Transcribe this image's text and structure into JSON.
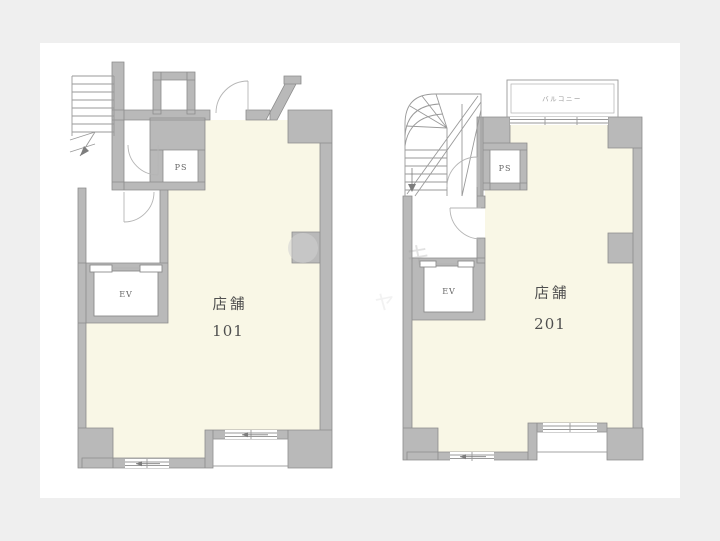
{
  "page": {
    "background_color": "#efefef",
    "canvas_background_color": "#ffffff"
  },
  "colors": {
    "wall": "#b9b9b9",
    "wall_outline": "#8c8c8c",
    "room_fill": "#f9f7e6",
    "line": "#9a9a9a",
    "label_text": "#4f4f4f"
  },
  "plans": [
    {
      "id": "unit-101",
      "room_label": "店舗",
      "unit_number": "101",
      "pipe_space_label": "PS",
      "elevator_label": "EV"
    },
    {
      "id": "unit-201",
      "room_label": "店舗",
      "unit_number": "201",
      "pipe_space_label": "PS",
      "elevator_label": "EV",
      "balcony_label": "バルコニー"
    }
  ],
  "watermark": {
    "characters": [
      "キ",
      "ャ"
    ]
  }
}
